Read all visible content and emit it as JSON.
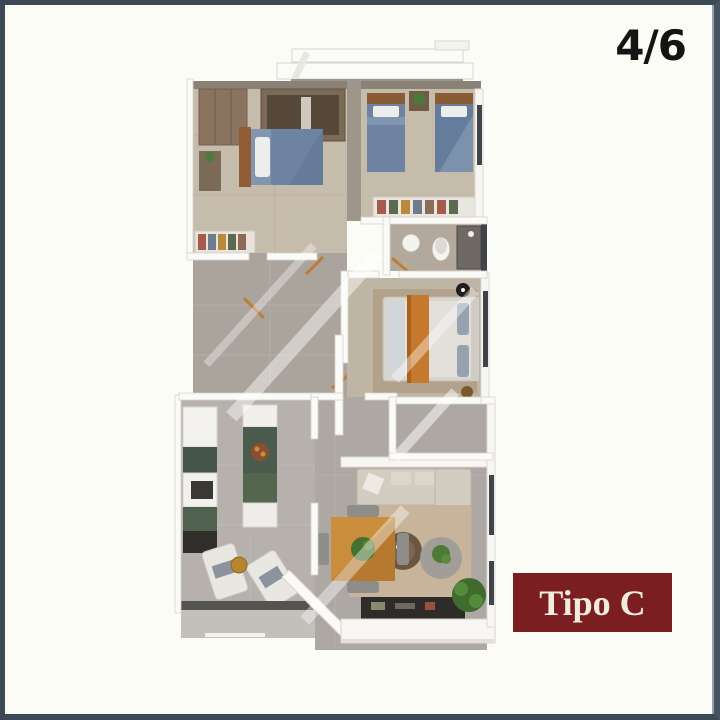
{
  "viewer": {
    "image_counter": "4/6",
    "unit_label": "Tipo C"
  },
  "colors": {
    "frame_border": "#3e4956",
    "frame_highlight": "#8fa0ae",
    "background": "#fcfcf6",
    "counter_text": "#141414",
    "label_background": "#7a1e21",
    "label_text": "#f2ecdf",
    "bed_blue": "#6d83a1",
    "accent_orange": "#c5792c",
    "wood": "#b57a30",
    "floor_beige": "#c6bcac",
    "floor_gray": "#aba49c",
    "plant_green": "#4c7a38"
  },
  "floor_plan": {
    "type": "apartment-top-view-render",
    "unit": "Tipo C",
    "rooms": [
      "bedroom-1",
      "bedroom-2",
      "bathroom-1",
      "hallway",
      "master-bedroom",
      "bathroom-2",
      "kitchen",
      "dining-area",
      "living-room",
      "terrace",
      "balcony"
    ],
    "furniture": [
      "double-bed",
      "single-bed",
      "single-bed",
      "wardrobe",
      "closet",
      "sink",
      "toilet",
      "shower",
      "master-bed-orange-runner",
      "kitchen-counters",
      "kitchen-island",
      "dining-table",
      "dining-chairs",
      "l-shaped-sofa",
      "coffee-tables",
      "tv-console",
      "lounge-chairs",
      "plants",
      "rug"
    ]
  }
}
